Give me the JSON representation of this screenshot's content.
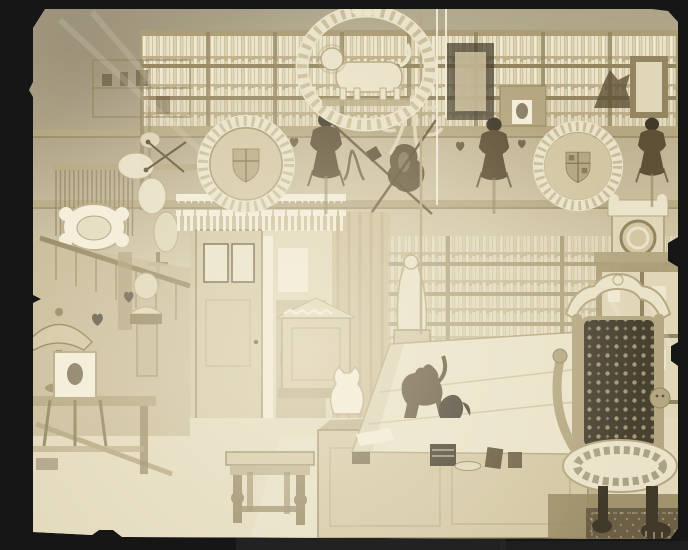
{
  "figure": {
    "kind": "photograph",
    "style": "faded sepia albumen print mounted on a black card, clipped corners and chipped edges",
    "title": "Interior of a cluttered Victorian collector's study",
    "description": "Faded sepia photograph of a crowded antiquary's study: glazed bookcases line the upper walls; a carved oval laurel wreath holding a standing lion sculpture hangs from the ceiling beside white cords; two circular wreathed coats of arms, suits of armour, a breastplate, helmets and antlers decorate a high shelf; below, a doorway with pierced gothic cresting and a curtain, a staircase with heart-pierced panels, a marble bust, a shaded lamp and a framed portrait on an easel; in the foreground a desk with a large sloped cover, cat figurines and small objects, a joint stool, a carved chest, a white statuette, a longcase clock, a glazed display cabinet, and a throne chair upholstered in dark damask with lion-paw feet standing on a patterned rug."
  },
  "colors": {
    "mount": "#161616",
    "mount2": "#2e2e2e",
    "white": "#f3edda",
    "cream": "#eae3c9",
    "light": "#e0d7b8",
    "tan": "#d3c7a3",
    "wall": "#c6b995",
    "curtain": "#cdbf99",
    "wood": "#ab9d77",
    "rail": "#93855f",
    "shade": "#b5a781",
    "ink": "#5e5136",
    "dark": "#41392a",
    "damask": "#4a4231",
    "damasklight": "#b9ae8a",
    "carpet": "#998b64",
    "rug": "#6b5f45",
    "floor": "#e3dabd",
    "bookbg": "#bdaf89",
    "book1": "#eae3c9",
    "book2": "#d9cfae",
    "book3": "#f0e9d3"
  },
  "scene": {
    "objects": [
      {
        "name": "photo-mount",
        "label": "black card mount"
      },
      {
        "name": "study-photo",
        "label": "sepia photograph of study interior"
      },
      {
        "name": "upper-bookshelves",
        "label": "glazed bookcases with books"
      },
      {
        "name": "lion-wreath",
        "label": "carved oval wreath with standing lion"
      },
      {
        "name": "hanging-cords",
        "label": "white cords from ceiling"
      },
      {
        "name": "heraldic-plaque-left",
        "label": "circular wreathed coat of arms"
      },
      {
        "name": "heraldic-plaque-right",
        "label": "circular wreathed coat of arms"
      },
      {
        "name": "suit-of-armour-left",
        "label": "dark suit of armour"
      },
      {
        "name": "breastplate",
        "label": "cuirass on shelf"
      },
      {
        "name": "suit-of-armour-right",
        "label": "suit of armour"
      },
      {
        "name": "suit-of-armour-far-right",
        "label": "suit of armour"
      },
      {
        "name": "antlers",
        "label": "hanging antlers and halberds"
      },
      {
        "name": "gothic-fretwork-valance",
        "label": "white pierced cresting over doorway"
      },
      {
        "name": "doorway",
        "label": "open door with framed prints"
      },
      {
        "name": "curtain",
        "label": "portiere curtain"
      },
      {
        "name": "staircase",
        "label": "stairs with heart-pierced panels"
      },
      {
        "name": "fringed-hanging",
        "label": "fringed textile on rod"
      },
      {
        "name": "carved-cartouche",
        "label": "white baroque cartouche"
      },
      {
        "name": "marble-bust",
        "label": "bust on newel pedestal"
      },
      {
        "name": "table-lamp",
        "label": "shaded lamp"
      },
      {
        "name": "framed-portrait",
        "label": "portrait photograph on easel"
      },
      {
        "name": "side-table",
        "label": "low side table"
      },
      {
        "name": "white-statue",
        "label": "white statuette on pedestal"
      },
      {
        "name": "carved-chest",
        "label": "chest with pitched cresting lid"
      },
      {
        "name": "longcase-clock",
        "label": "tall clock with round dial"
      },
      {
        "name": "display-cabinet",
        "label": "glazed display cabinet"
      },
      {
        "name": "desk",
        "label": "desk with sloped cover"
      },
      {
        "name": "black-cat-figurine",
        "label": "dark cat figure"
      },
      {
        "name": "white-cat-figurine",
        "label": "white cat figure"
      },
      {
        "name": "monkey-figurine",
        "label": "small dark animal figure"
      },
      {
        "name": "desk-objects",
        "label": "books, tray and small objects"
      },
      {
        "name": "joint-stool",
        "label": "turned-leg stool"
      },
      {
        "name": "throne-chair",
        "label": "carved chair with dark damask back"
      },
      {
        "name": "carpet",
        "label": "patterned carpet"
      },
      {
        "name": "rug",
        "label": "dark rug under chair"
      }
    ]
  }
}
